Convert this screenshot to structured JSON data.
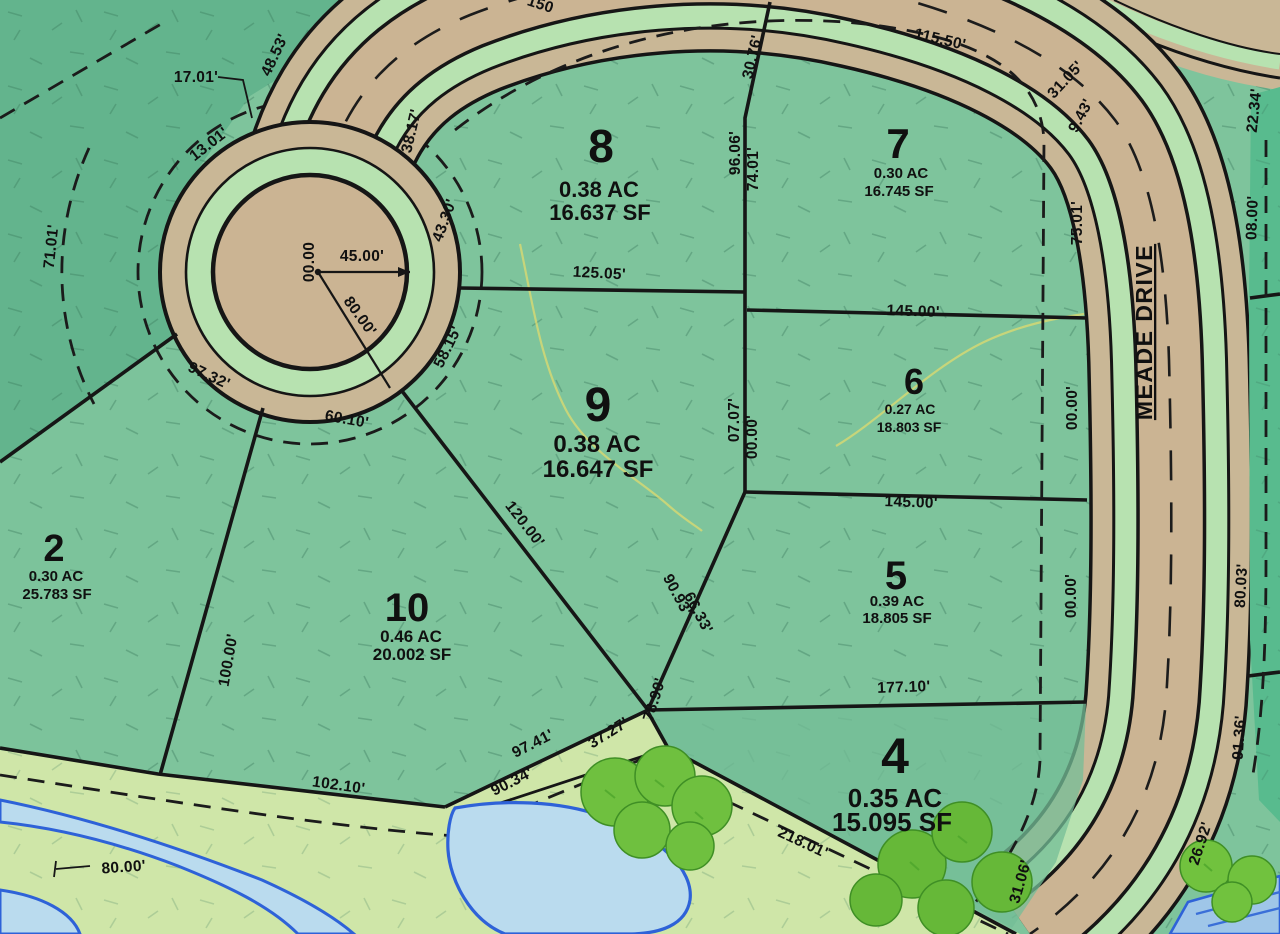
{
  "map": {
    "street": {
      "name": "MEADE DRIVE"
    },
    "lots": [
      {
        "id": "lot-2",
        "number": "2",
        "acreage": "0.30 AC",
        "area": "25.783 SF"
      },
      {
        "id": "lot-4",
        "number": "4",
        "acreage": "0.35 AC",
        "area": "15.095 SF"
      },
      {
        "id": "lot-5",
        "number": "5",
        "acreage": "0.39 AC",
        "area": "18.805 SF"
      },
      {
        "id": "lot-6",
        "number": "6",
        "acreage": "0.27 AC",
        "area": "18.803 SF"
      },
      {
        "id": "lot-7",
        "number": "7",
        "acreage": "0.30 AC",
        "area": "16.745 SF"
      },
      {
        "id": "lot-8",
        "number": "8",
        "acreage": "0.38 AC",
        "area": "16.637 SF"
      },
      {
        "id": "lot-9",
        "number": "9",
        "acreage": "0.38 AC",
        "area": "16.647 SF"
      },
      {
        "id": "lot-10",
        "number": "10",
        "acreage": "0.46 AC",
        "area": "20.002 SF"
      }
    ],
    "dimensions": [
      {
        "text": "17.01'"
      },
      {
        "text": "48.53'"
      },
      {
        "text": "13.01'"
      },
      {
        "text": "150"
      },
      {
        "text": "38.17'"
      },
      {
        "text": "43.30'"
      },
      {
        "text": "71.01'"
      },
      {
        "text": "97.32'"
      },
      {
        "text": "45.00'"
      },
      {
        "text": "00.00"
      },
      {
        "text": "80.00'"
      },
      {
        "text": "60.10'"
      },
      {
        "text": "58.15'"
      },
      {
        "text": "115.50'"
      },
      {
        "text": "30.76'"
      },
      {
        "text": "31.05'"
      },
      {
        "text": "9.43'"
      },
      {
        "text": "22.34'"
      },
      {
        "text": "08.00'"
      },
      {
        "text": "125.05'"
      },
      {
        "text": "96.06'"
      },
      {
        "text": "74.01'"
      },
      {
        "text": "75.01'"
      },
      {
        "text": "145.00'"
      },
      {
        "text": "07.07'"
      },
      {
        "text": "00.00'"
      },
      {
        "text": "00.00'"
      },
      {
        "text": "145.00'"
      },
      {
        "text": "00.00'"
      },
      {
        "text": "80.03'"
      },
      {
        "text": "120.00'"
      },
      {
        "text": "90.93'"
      },
      {
        "text": "66.33'"
      },
      {
        "text": "100.00'"
      },
      {
        "text": "177.10'"
      },
      {
        "text": "91.36'"
      },
      {
        "text": "97.41'"
      },
      {
        "text": "37.27'"
      },
      {
        "text": "78.90'"
      },
      {
        "text": "90.34'"
      },
      {
        "text": "102.10'"
      },
      {
        "text": "218.01'"
      },
      {
        "text": "80.00'"
      },
      {
        "text": "26.92'"
      },
      {
        "text": "31.06'"
      }
    ],
    "colors": {
      "lot_green": "#7ec49c",
      "lot_green_dark": "#63b48d",
      "lot_strip_teal": "#58bb8e",
      "band_green": "#cfe6a8",
      "road_shoulder_tan": "#c9b796",
      "pavement_tan": "#cbb493",
      "verge_green": "#b7e2b0",
      "line_black": "#1a1a1a",
      "water_fill": "#badbee",
      "water_edge": "#2e62d8",
      "tree_green": "#6fc03f",
      "contour_yellow": "#d9d972"
    }
  }
}
